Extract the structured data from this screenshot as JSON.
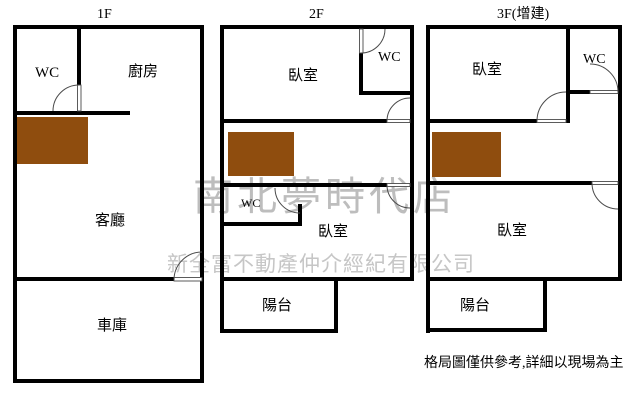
{
  "floors": [
    {
      "label": "1F",
      "rooms": {
        "wc": "WC",
        "kitchen": "廚房",
        "living": "客廳",
        "garage": "車庫"
      }
    },
    {
      "label": "2F",
      "rooms": {
        "bedroom_top": "臥室",
        "wc_top": "WC",
        "wc_mid": "WC",
        "bedroom_bottom": "臥室",
        "balcony": "陽台"
      }
    },
    {
      "label": "3F(增建)",
      "rooms": {
        "bedroom_top": "臥室",
        "wc_top": "WC",
        "bedroom_bottom": "臥室",
        "balcony": "陽台"
      }
    }
  ],
  "watermarks": {
    "line1": "南北夢時代店",
    "line2": "新全富不動產仲介經紀有限公司"
  },
  "disclaimer": "格局圖僅供參考,詳細以現場為主",
  "colors": {
    "wall": "#000000",
    "stairs": "#8F4D0E",
    "watermark": "#bdbdbd"
  }
}
